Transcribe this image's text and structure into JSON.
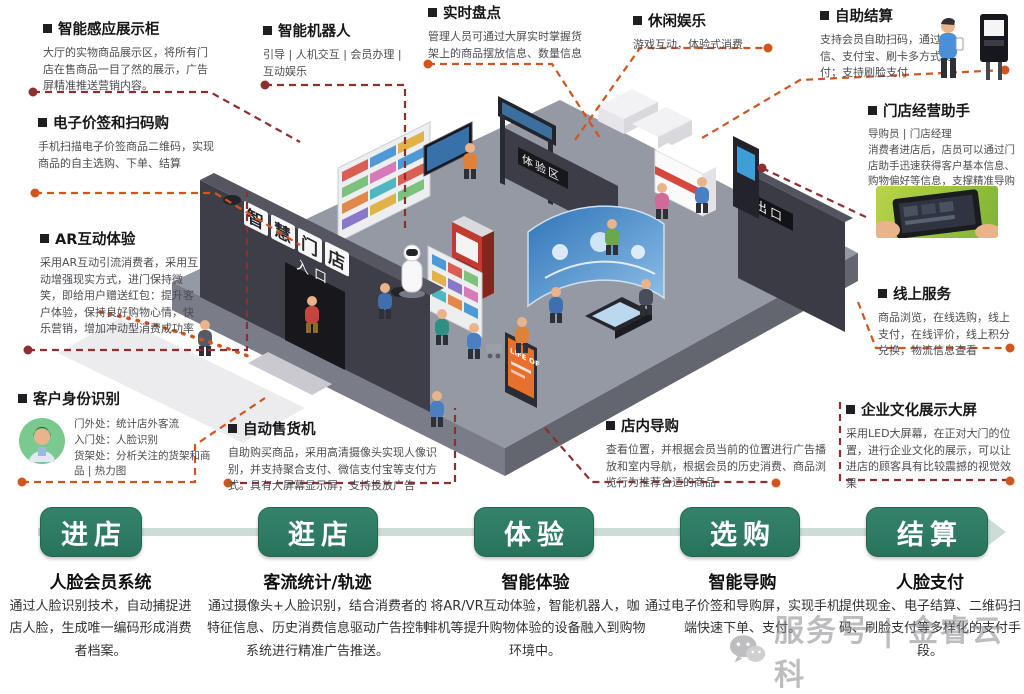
{
  "callouts": [
    {
      "title": "智能感应展示柜",
      "desc": "大厅的实物商品展示区，将所有门店在售商品一目了然的展示，广告屏精准推送营销内容。"
    },
    {
      "title": "电子价签和扫码购",
      "desc": "手机扫描电子价签商品二维码，实现商品的自主选购、下单、结算"
    },
    {
      "title": "AR互动体验",
      "desc": "采用AR互动引流消费者，采用互动增强现实方式，进门保持微笑，即给用户赠送红包：提升客户体验，保持良好购物心情，快乐营销，增加冲动型消费成功率"
    },
    {
      "title": "客户身份识别",
      "desc": "门外处：统计店外客流\n入门处：人脸识别\n货架处：分析关注的货架和商品 | 热力图"
    },
    {
      "title": "智能机器人",
      "desc": "引导 | 人机交互 | 会员办理 | 互动娱乐"
    },
    {
      "title": "实时盘点",
      "desc": "管理人员可通过大屏实时掌握货架上的商品摆放信息、数量信息"
    },
    {
      "title": "休闲娱乐",
      "desc": "游戏互动，体验式消费"
    },
    {
      "title": "自助结算",
      "desc": "支持会员自助扫码，通过微信、支付宝、刷卡多方式支付；支持刷脸支付"
    },
    {
      "title": "门店经营助手",
      "desc": "导购员 | 门店经理\n消费者进店后，店员可以通过门店助手迅速获得客户基本信息、购物偏好等信息，支撑精准导购"
    },
    {
      "title": "线上服务",
      "desc": "商品浏览，在线选购，线上支付，在线评价，线上积分兑换，物流信息查看"
    },
    {
      "title": "企业文化展示大屏",
      "desc": "采用LED大屏幕，在正对大门的位置，进行企业文化的展示，可以让进店的顾客具有比较震撼的视觉效果"
    },
    {
      "title": "店内导购",
      "desc": "查看位置，并根据会员当前的位置进行广告播放和室内导航，根据会员的历史消费、商品浏览行为推荐合适的商品"
    },
    {
      "title": "自动售货机",
      "desc": "自助购买商品，采用高清摄像头实现人像识别，并支持聚合支付、微信支付宝等支付方式。具有大屏幕显示屏，支持投放广告"
    }
  ],
  "scene": {
    "store_sign": "智慧门店",
    "entrance_label": "入口",
    "exit_label": "出口",
    "experience_label": "体验区",
    "poster_text": "LIFE OF"
  },
  "flow": {
    "steps": [
      {
        "label": "进店",
        "subtitle": "人脸会员系统",
        "desc": "通过人脸识别技术，自动捕捉进店人脸，生成唯一编码形成消费者档案。"
      },
      {
        "label": "逛店",
        "subtitle": "客流统计/轨迹",
        "desc": "通过摄像头+人脸识别，结合消费者的特征信息、历史消费信息驱动广告控制系统进行精准广告推送。"
      },
      {
        "label": "体验",
        "subtitle": "智能体验",
        "desc": "将AR/VR互动体验，智能机器人，咖啡机等提升购物体验的设备融入到购物环境中。"
      },
      {
        "label": "选购",
        "subtitle": "智能导购",
        "desc": "通过电子价签和导购屏，实现手机端快速下单、支付。"
      },
      {
        "label": "结算",
        "subtitle": "人脸支付",
        "desc": "提供现金、电子结算、二维码扫码、刷脸支付等多样化的支付手段。"
      }
    ]
  },
  "watermark": {
    "text": "服务号 | 金睿云科"
  },
  "colors": {
    "accent_green": "#2e7c66",
    "leader_maroon": "#8e2f2f",
    "leader_orange": "#d2551e"
  }
}
